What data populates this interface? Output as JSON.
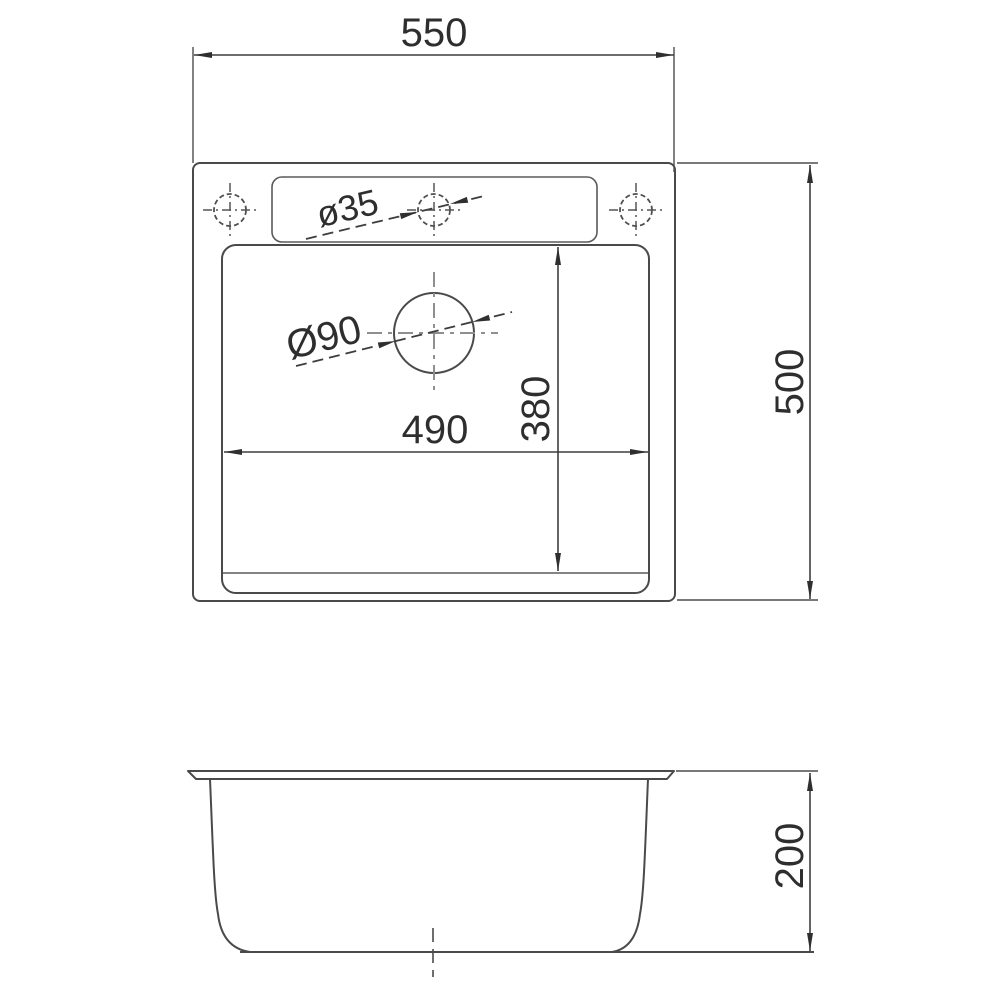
{
  "drawing": {
    "colors": {
      "outline": "#4a4a4a",
      "dimension_lines": "#3d3d3d",
      "centerline_gray": "#8f8f8f",
      "text": "#2e2e2e",
      "background": "#ffffff"
    },
    "dimensions": {
      "overall_width": "550",
      "overall_depth": "500",
      "bowl_width": "490",
      "bowl_depth": "380",
      "bowl_height": "200",
      "faucet_hole_diameter": "ø35",
      "drain_hole_diameter": "Ø90"
    }
  }
}
